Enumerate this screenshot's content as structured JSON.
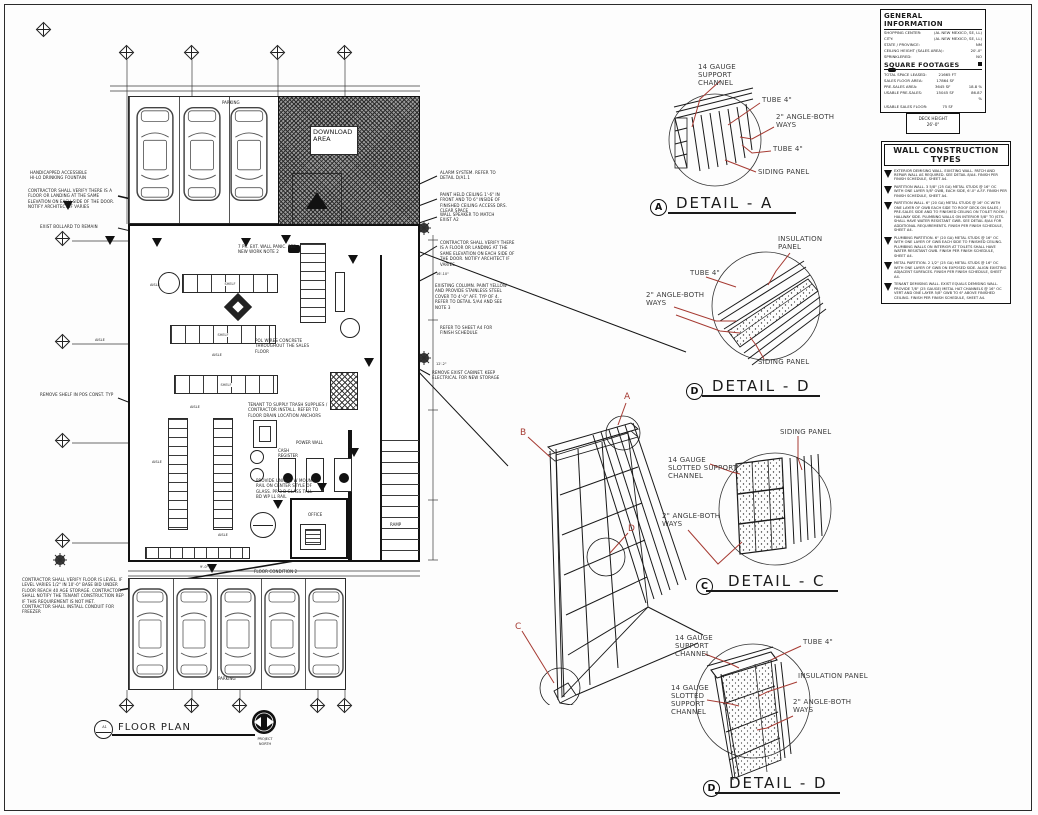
{
  "plan": {
    "title": "FLOOR PLAN",
    "bubble": "A1",
    "north_1": "PROJECT",
    "north_2": "NORTH",
    "parking_top": "PARKING",
    "parking_bottom": "PARKING",
    "download": "DOWNLOAD AREA",
    "office": "OFFICE",
    "ramp": "RAMP",
    "power_wall": "POWER WALL",
    "cash_register": "CASH REGISTER",
    "shelf": "SHELF",
    "aisle": "AISLE",
    "dims": {
      "d1": "16'-10\"",
      "d2": "12'-2\"",
      "d3": "9'-0\""
    }
  },
  "plan_notes": [
    "HANDICAPPED ACCESSIBLE HI-LO DRINKING FOUNTAIN",
    "CONTRACTOR SHALL VERIFY THERE IS A FLOOR OR LANDING AT THE SAME ELEVATION ON EACH SIDE OF THE DOOR. NOTIFY ARCHITECT IF VARIES",
    "EXIST BOLLARD TO REMAIN",
    "REMOVE SHELF IN POS CONST. TYP",
    "ALARM SYSTEM. REFER TO DETAIL D/A1.1",
    "PAINT HELD CEILING 1'-6\" IN FRONT AND TO 6\" INSIDE OF FINISHED CEILING ACCESS DRS. CLEAR SPACE",
    "WALL SPEAKER TO MATCH EXIST A2",
    "CONTRACTOR SHALL VERIFY THERE IS A FLOOR OR LANDING AT THE SAME ELEVATION ON EACH SIDE OF THE DOOR. NOTIFY ARCHITECT IF VARIES",
    "EXISTING COLUMN. PAINT YELLOW AND PROVIDE STAINLESS STEEL COVER TO 4'-0\" AFF. TYP OF 4. REFER TO DETAIL 5/A4 AND SEE NOTE 3",
    "REFER TO SHEET A4 FOR FINISH SCHEDULE",
    "REMOVE EXIST CABINET. KEEP ELECTRICAL FOR NEW STORAGE",
    "TENANT TO SUPPLY TRASH SUPPLIES / CONTRACTOR INSTALL. REFER TO FLOOR DRAIN LOCATION ANCHORS",
    "POL WIRES CONCRETE THROUGHOUT THE SALES FLOOR",
    "7 PR. EXT. WALL PANIC. SEE NEW WORK NOTE 2",
    "PROVIDE UNIQUE W MOUNT RAIL ON CENTER STYLE OF GLASS. PR 3-B GLASS TALL BD WP LL RAIL",
    "CONTRACTOR SHALL VERIFY FLOOR IS LEVEL. IF LEVEL VARIES 1/2\" IN 10'-0\" BASE BID UNDER FLOOR REACH 40 AGE STORAGE. CONTRACTOR SHALL NOTIFY THE TENANT CONSTRUCTION REP IF THIS REQUIREMENT IS NOT MET. CONTRACTOR SHALL INSTALL CONDUIT FOR FREEZER",
    "FLOOR CONDITION 2"
  ],
  "general_info": {
    "title": "GENERAL INFORMATION",
    "rows": [
      {
        "label": "SHOPPING CENTER:",
        "value": "(AL NEW MEXICO, SE, LL)"
      },
      {
        "label": "CITY:",
        "value": "(AL NEW MEXICO, SE, LL)"
      },
      {
        "label": "STATE / PROVINCE:",
        "value": "NM"
      },
      {
        "label": "CEILING HEIGHT (SALES AREA):",
        "value": "20'-0\""
      },
      {
        "label": "SPRINKLERED:",
        "value": "NO"
      }
    ],
    "sf_title": "SQUARE FOOTAGES",
    "sf_rows": [
      {
        "label": "TOTAL SPACE LEASED:",
        "value": "21665  FT",
        "pct": ""
      },
      {
        "label": "SALES FLOOR AREA:",
        "value": "17864  SF",
        "pct": ""
      },
      {
        "label": "PRE-SALES AREA:",
        "value": "3645  SF",
        "pct": "18.8 %"
      },
      {
        "label": "USABLE PRE-SALES:",
        "value": "15045  SF",
        "pct": "86.87 %"
      },
      {
        "label": "USABLE SALES FLOOR:",
        "value": "75  SF",
        "pct": ""
      }
    ],
    "deck_label": "DECK HEIGHT",
    "deck_value": "26'-0\""
  },
  "wall_types": {
    "title": "WALL CONSTRUCTION TYPES",
    "items": [
      {
        "num": "1",
        "text": "EXTERIOR DEMISING WALL. EXISTING WALL. PATCH AND REPAIR WALL AS REQUIRED. SEE DETAIL 8/A4. FINISH PER FINISH SCHEDULE, SHEET A4."
      },
      {
        "num": "2",
        "text": "PARTITION WALL. 3 5/8\" (25 GA) METAL STUDS @ 16\" OC WITH ONE LAYER 5/8\" GWB, EACH SIDE, 6'-0\" A.F.F. FINISH PER FINISH SCHEDULE, SHEET A4."
      },
      {
        "num": "3",
        "text": "PARTITION WALL. 6\" (20 GA) METAL STUDS @ 16\" OC WITH ONE LAYER OF GWB EACH SIDE TO ROOF DECK ON SALES / PRE-SALES SIDE AND TO FINISHED CEILING ON TOILET ROOM / HALLWAY SIDE. PLUMBING WALLS ON INTERIOR 5/8\" TO JSTS. SHALL HAVE WATER RESISTANT GWB. SEE DETAIL 8/A4 FOR ADDITIONAL REQUIREMENTS. FINISH PER FINISH SCHEDULE, SHEET A4."
      },
      {
        "num": "4",
        "text": "PLUMBING PARTITION. 6\" (20 GA) METAL STUDS @ 16\" OC WITH ONE LAYER OF GWB EACH SIDE TO FINISHED CEILING. PLUMBING WALLS ON INTERIOR AT TOILETS SHALL HAVE WATER RESISTANT GWB. FINISH PER FINISH SCHEDULE, SHEET A4."
      },
      {
        "num": "5",
        "text": "METAL PARTITION. 2 1/2\" (25 GA) METAL STUDS @ 16\" OC WITH ONE LAYER OF GWB ON EXPOSED SIDE. ALIGN EXISTING ADJACENT SURFACES. FINISH PER FINISH SCHEDULE, SHEET A4."
      },
      {
        "num": "6",
        "text": "TENANT DEMISING WALL. EXIST EQUALS DEMISING WALL. PROVIDE 7/8\" (25 GAUGE) METAL HAT CHANNELS @ 16\" OC VERT AND ONE LAYER 5/8\" GWB TO 6\" ABOVE FINISHED CEILING. FINISH PER FINISH SCHEDULE, SHEET A4."
      }
    ]
  },
  "details": {
    "a": {
      "title": "DETAIL  - A",
      "bubble": "A",
      "support": "14 GAUGE  SUPPORT CHANNEL",
      "tube1": "TUBE 4\"",
      "angle": "2\" ANGLE-BOTH WAYS",
      "tube2": "TUBE 4\"",
      "siding": "SIDING PANEL"
    },
    "d1": {
      "title": "DETAIL  - D",
      "bubble": "D",
      "insulation": "INSULATION PANEL",
      "tube": "TUBE 4\"",
      "angle": "2\" ANGLE-BOTH WAYS",
      "siding": "SIDING PANEL"
    },
    "c": {
      "title": "DETAIL  - C",
      "bubble": "C",
      "siding": "SIDING PANEL",
      "slotted": "14 GAUGE SLOTTED SUPPORT CHANNEL",
      "angle": "2\" ANGLE-BOTH WAYS"
    },
    "d2": {
      "title": "DETAIL  - D",
      "bubble": "D",
      "support": "14 GAUGE  SUPPORT CHANNEL",
      "tube": "TUBE 4\"",
      "slotted": "14 GAUGE SLOTTED SUPPORT CHANNEL",
      "insulation": "INSULATION PANEL",
      "angle": "2\" ANGLE-BOTH WAYS"
    }
  },
  "iso": {
    "a": "A",
    "b": "B",
    "c": "C",
    "d": "D"
  }
}
